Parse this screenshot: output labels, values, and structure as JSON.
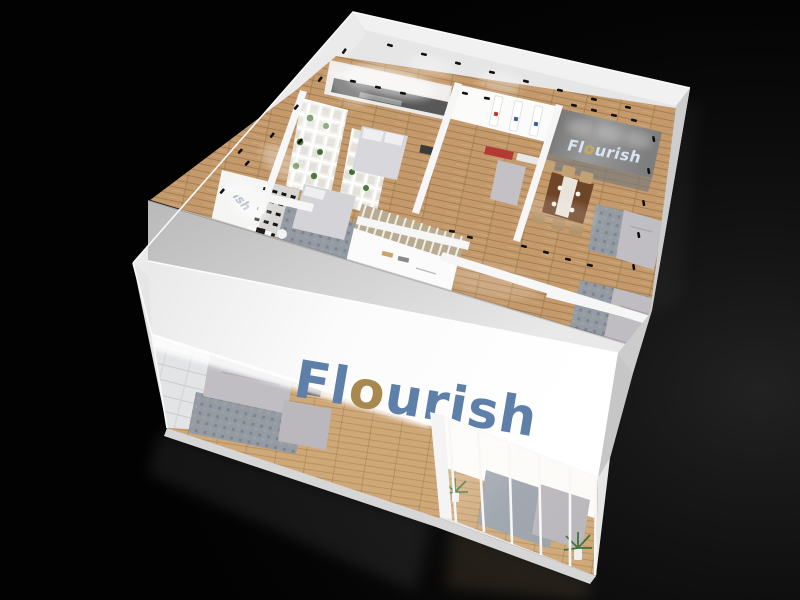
{
  "scene": {
    "brand": "Flourish",
    "description": "Aerial 3D render of the Flourish furniture exhibition booth on a black studio floor",
    "setting": "night studio backdrop"
  },
  "signs": {
    "fascia": {
      "part_fl": "Fl",
      "part_o": "o",
      "part_rest": "urish"
    },
    "interior": {
      "part_fl": "Fl",
      "part_o": "o",
      "part_rest": "urish"
    },
    "left_wall_partial": "ish"
  },
  "colors": {
    "logo_blue": "#5E7FA7",
    "logo_gold": "#A8884E",
    "sign_glow_blue": "#D9E4F2",
    "sign_glow_gold": "#C9A85C",
    "background": "#000000",
    "wall_white": "#F2F2F2",
    "floor_wood": "#C49A6C",
    "rug_gray": "#9097A0",
    "sofa_gray": "#C0BEC2",
    "table_brown": "#6F4528",
    "plant_green": "#4D7A3A"
  }
}
